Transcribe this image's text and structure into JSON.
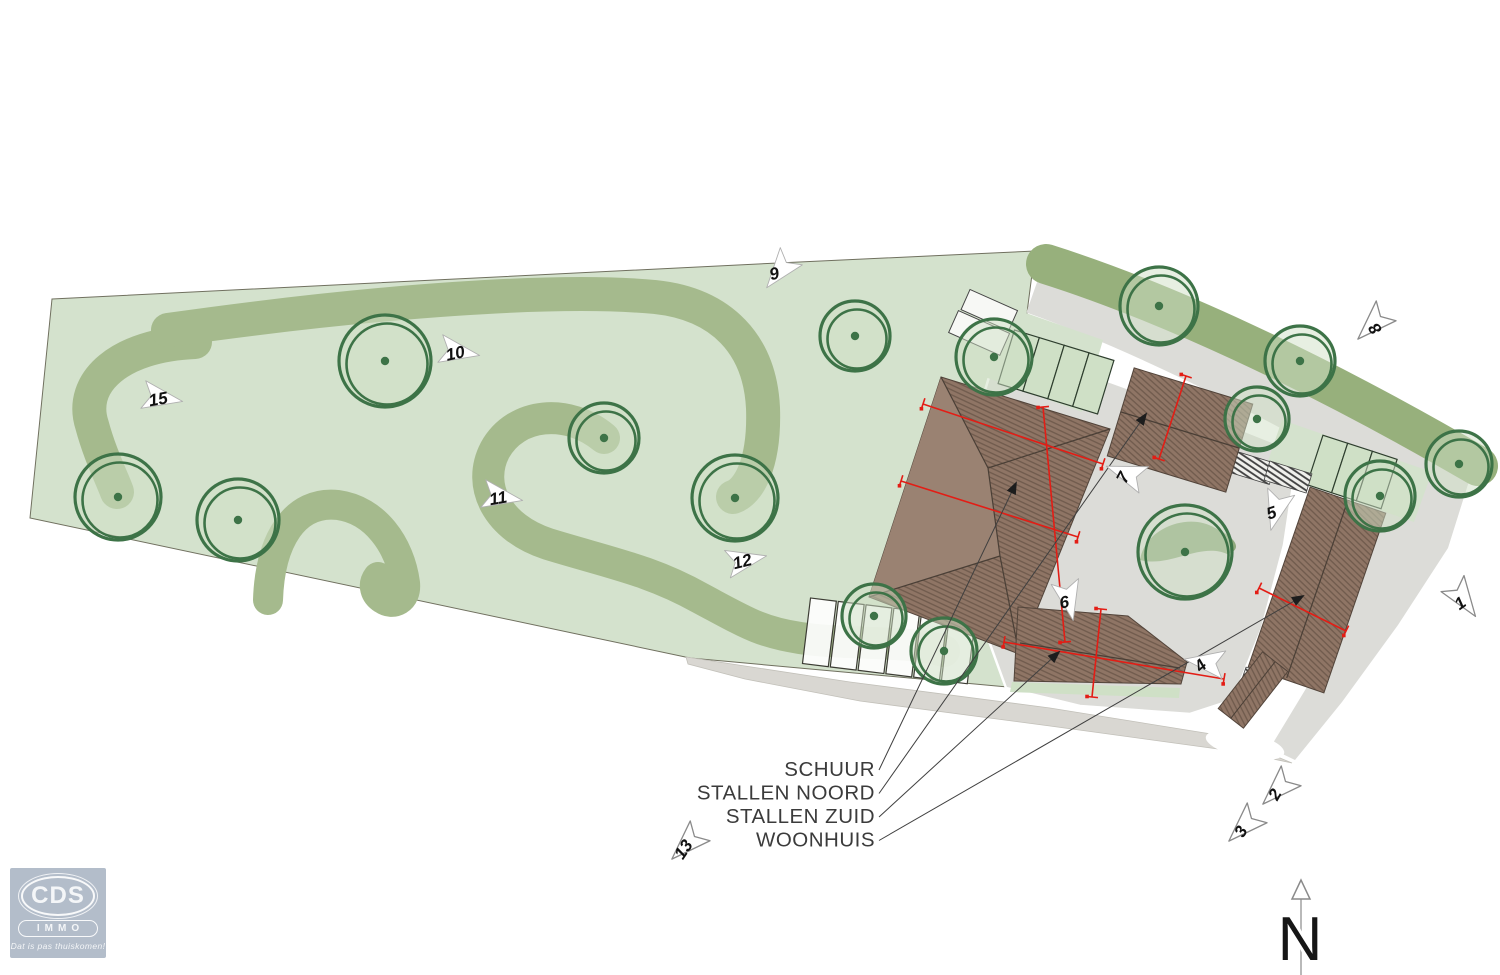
{
  "plan_title": "terrain site plan with numbered photo viewpoints",
  "colors": {
    "field": "#d4e2cd",
    "hedge": "#a5ba8d",
    "hedge_dark": "#97b07c",
    "tree_ring": "#3d7347",
    "tree_fill": "#cfe0c6",
    "paving": "#dcdcd8",
    "paving_south": "#d9d7d2",
    "roof": "#8f7565",
    "roof_hatch": "#6f5a4c",
    "dimension_red": "#e31d15",
    "leader": "#3f3f3f",
    "marker_fill": "#ffffff",
    "marker_stroke": "#8f8f8f",
    "label_text": "#3b3b3b",
    "logo_bg": "#b3bdca"
  },
  "legend": {
    "anchor_x": 875,
    "items": [
      {
        "label": "SCHUUR",
        "y": 776,
        "tx": 1016,
        "ty": 483
      },
      {
        "label": "STALLEN NOORD",
        "y": 799.5,
        "tx": 1146,
        "ty": 414
      },
      {
        "label": "STALLEN ZUID",
        "y": 823,
        "tx": 1059,
        "ty": 652
      },
      {
        "label": "WOONHUIS",
        "y": 846.5,
        "tx": 1303,
        "ty": 596
      }
    ]
  },
  "markers": [
    {
      "n": "1",
      "x": 1464,
      "y": 600,
      "rot": 55,
      "nrot": -35,
      "outline": true
    },
    {
      "n": "2",
      "x": 1277,
      "y": 790,
      "rot": 135,
      "nrot": -60,
      "outline": true
    },
    {
      "n": "3",
      "x": 1243,
      "y": 827,
      "rot": 135,
      "nrot": -60,
      "outline": true
    },
    {
      "n": "4",
      "x": 1204,
      "y": 662,
      "rot": 188,
      "nrot": -42,
      "outline": false
    },
    {
      "n": "5",
      "x": 1276,
      "y": 511,
      "rot": 105,
      "nrot": -18,
      "outline": false
    },
    {
      "n": "6",
      "x": 1069,
      "y": 601,
      "rot": 78,
      "nrot": -10,
      "outline": false
    },
    {
      "n": "7",
      "x": 1125,
      "y": 473,
      "rot": 200,
      "nrot": -62,
      "outline": false
    },
    {
      "n": "8",
      "x": 1372,
      "y": 325,
      "rot": 135,
      "nrot": -125,
      "outline": true
    },
    {
      "n": "9",
      "x": 779,
      "y": 272,
      "rot": 128,
      "nrot": -15,
      "outline": false
    },
    {
      "n": "10",
      "x": 460,
      "y": 352,
      "rot": 10,
      "nrot": -12,
      "outline": false
    },
    {
      "n": "11",
      "x": 503,
      "y": 497,
      "rot": 10,
      "nrot": -10,
      "outline": false
    },
    {
      "n": "12",
      "x": 747,
      "y": 560,
      "rot": -12,
      "nrot": -14,
      "outline": false
    },
    {
      "n": "13",
      "x": 686,
      "y": 845,
      "rot": 135,
      "nrot": -56,
      "outline": true
    },
    {
      "n": "15",
      "x": 163,
      "y": 398,
      "rot": 10,
      "nrot": -10,
      "outline": false
    }
  ],
  "trees": [
    {
      "x": 385,
      "y": 361,
      "r": 46
    },
    {
      "x": 118,
      "y": 497,
      "r": 43
    },
    {
      "x": 238,
      "y": 520,
      "r": 41
    },
    {
      "x": 604,
      "y": 438,
      "r": 35
    },
    {
      "x": 735,
      "y": 498,
      "r": 43
    },
    {
      "x": 855,
      "y": 336,
      "r": 35
    },
    {
      "x": 994,
      "y": 357,
      "r": 38
    },
    {
      "x": 874,
      "y": 616,
      "r": 32
    },
    {
      "x": 944,
      "y": 651,
      "r": 33
    },
    {
      "x": 1159,
      "y": 306,
      "r": 39
    },
    {
      "x": 1257,
      "y": 419,
      "r": 32
    },
    {
      "x": 1300,
      "y": 361,
      "r": 35
    },
    {
      "x": 1380,
      "y": 496,
      "r": 35
    },
    {
      "x": 1459,
      "y": 464,
      "r": 33
    },
    {
      "x": 1185,
      "y": 552,
      "r": 47,
      "blob": true
    }
  ],
  "dimension_lines": [
    [
      923,
      404,
      1103,
      464
    ],
    [
      901,
      481,
      1078,
      537
    ],
    [
      1043,
      407,
      1065,
      642
    ],
    [
      1186,
      376,
      1159,
      459
    ],
    [
      1004,
      642,
      1224,
      679
    ],
    [
      1101,
      609,
      1092,
      697
    ],
    [
      1259,
      588,
      1346,
      631
    ]
  ],
  "north": {
    "label": "N"
  },
  "logo": {
    "top": "CDS",
    "bottom": "IMMO",
    "tagline": "Dat is pas thuiskomen!"
  }
}
